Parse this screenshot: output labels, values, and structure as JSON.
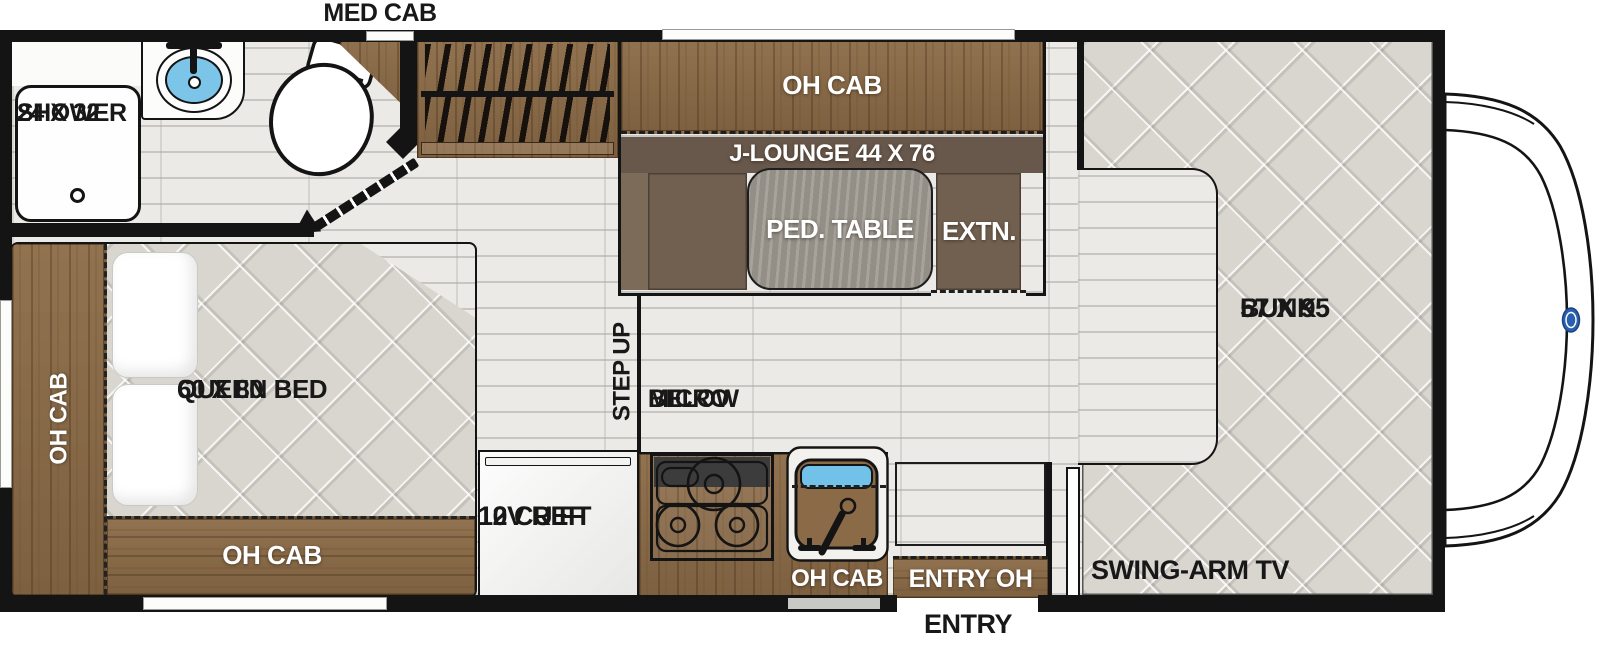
{
  "labels": {
    "med_cab": "MED CAB",
    "shower_l1": "SHOWER",
    "shower_l2": "24 X 32",
    "lounge_oh_cab": "OH CAB",
    "j_lounge": "J-LOUNGE 44 X 76",
    "ped_table": "PED. TABLE",
    "extn": "EXTN.",
    "bunk_l1": "BUNK",
    "bunk_l2": "57 X 95",
    "swing_arm_tv": "SWING-ARM TV",
    "queen_l1": "QUEEN BED",
    "queen_l2": "60 X 80",
    "bed_oh_cab_left": "OH CAB",
    "bed_oh_cab_bottom": "OH CAB",
    "fridge_l1": "10 CU FT",
    "fridge_l2": "12V REF",
    "micro_l1": "MICRO",
    "micro_l2": "BELOW",
    "step_up": "STEP UP",
    "kitchen_oh_cab": "OH CAB",
    "entry_oh": "ENTRY OH",
    "entry": "ENTRY"
  },
  "colors": {
    "wall": "#141414",
    "wood_cabinet": "#8b6b47",
    "lounge_seat": "#71604f",
    "lounge_backrest": "#68584b",
    "lounge_arm": "#7d6b5a",
    "pedestal_table": "#9b968d",
    "mattress": "#d9d6d0",
    "floor": "#eceae7",
    "sink_water": "#72c1e8",
    "ford_logo_blue": "#2a5fb0"
  }
}
